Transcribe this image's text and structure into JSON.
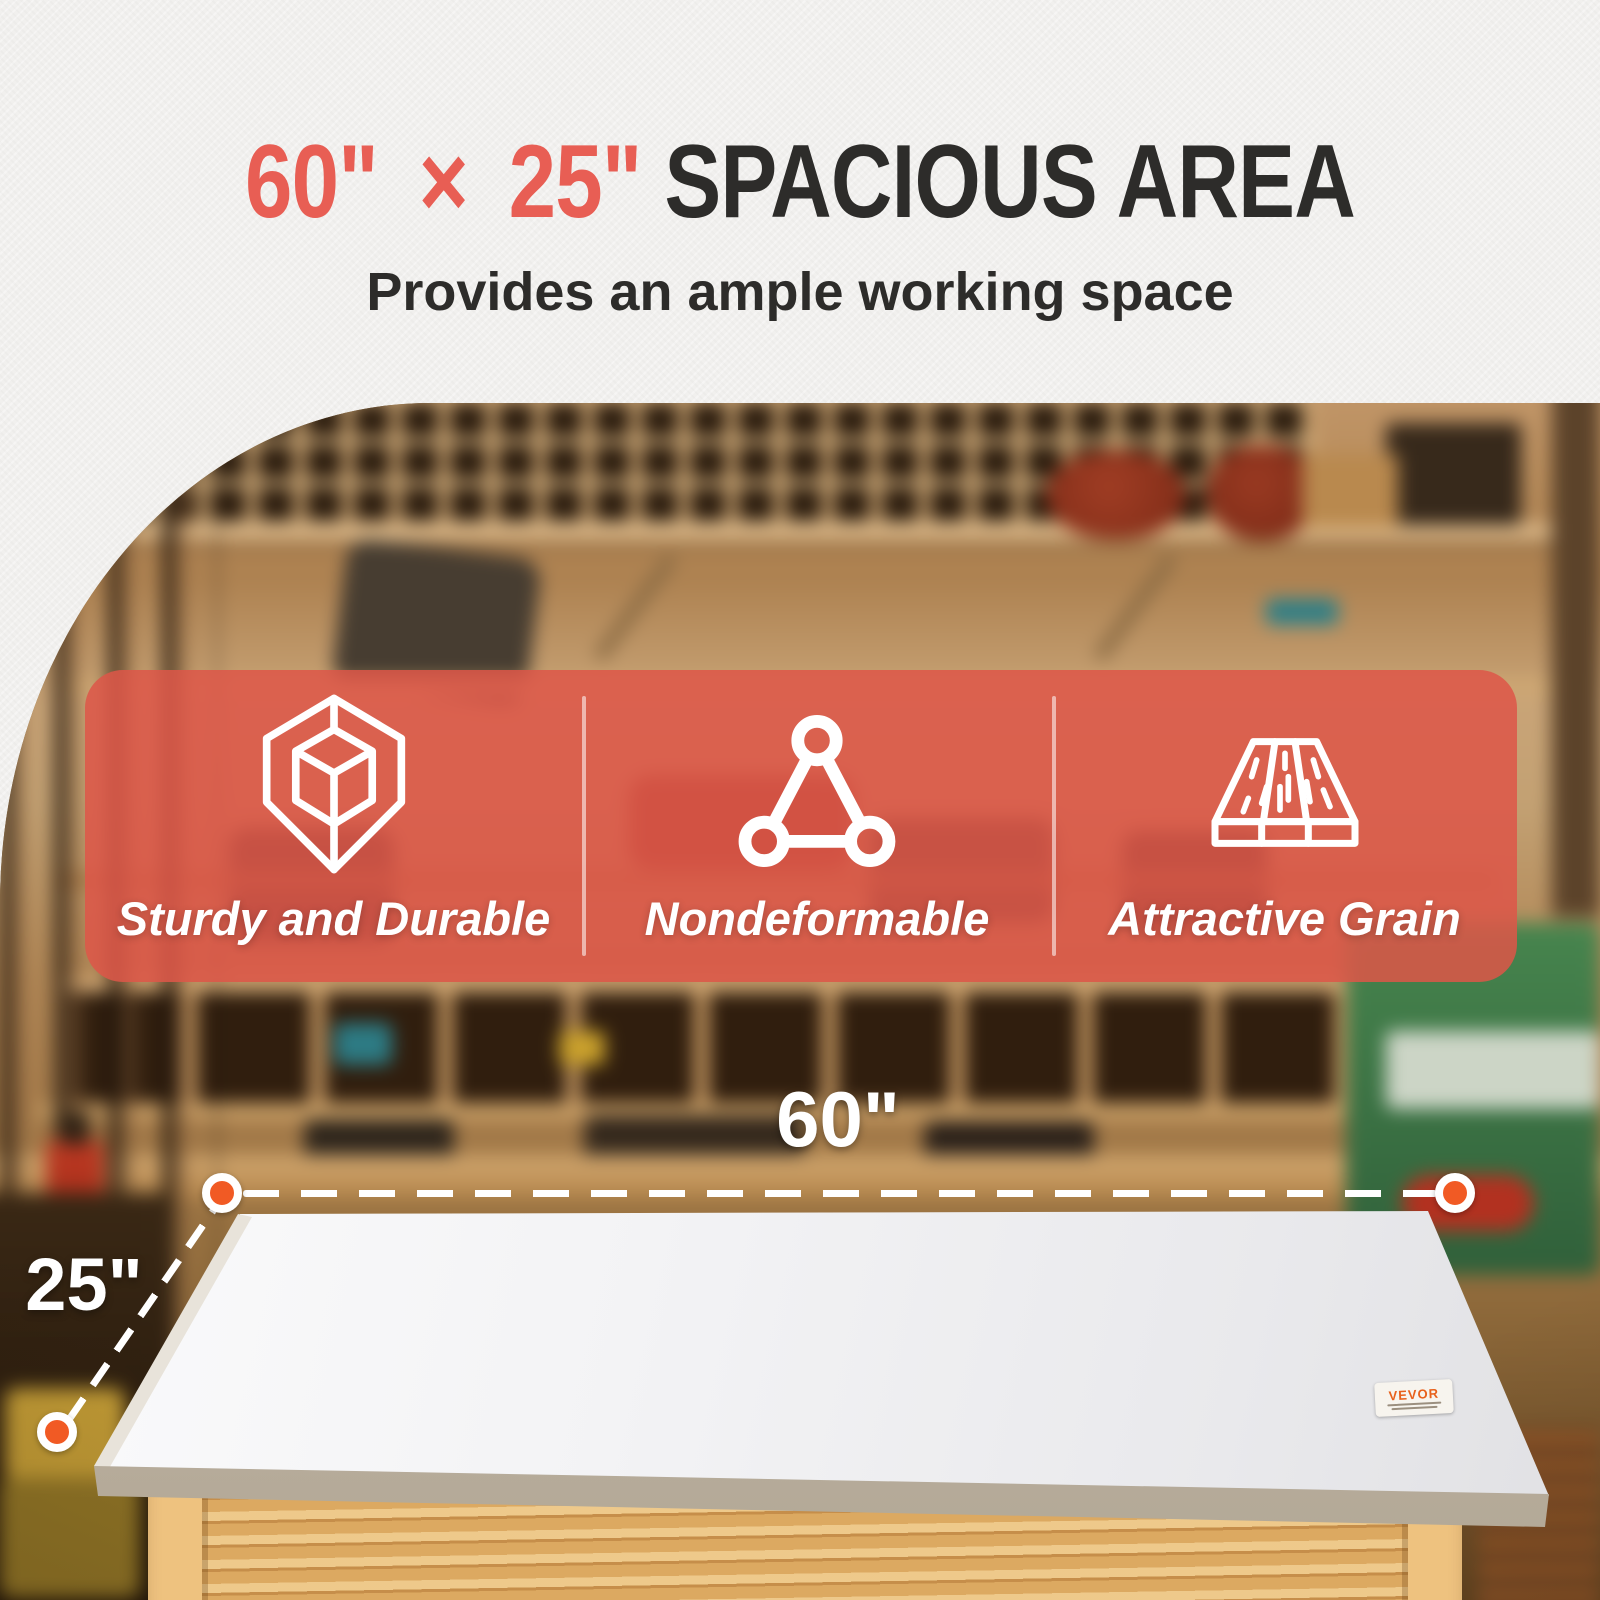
{
  "page": {
    "background": "#f1f0ee"
  },
  "header": {
    "title_accent": "60\" × 25\"",
    "title_rest": " SPACIOUS AREA",
    "subtitle": "Provides an ample working space",
    "accent_color": "#e85e54",
    "title_color": "#2d2c2a"
  },
  "features": {
    "panel_color": "#dd5648",
    "divider_color": "#ffffff",
    "items": [
      {
        "icon": "cube-wireframe-icon",
        "label": "Sturdy and Durable"
      },
      {
        "icon": "triangle-nodes-icon",
        "label": "Nondeformable"
      },
      {
        "icon": "wood-plank-icon",
        "label": "Attractive Grain"
      }
    ]
  },
  "dimensions": {
    "width_label": "60\"",
    "depth_label": "25\"",
    "marker_color": "#f15a24",
    "line_color": "#ffffff"
  },
  "product": {
    "brand_sticker": "VEVOR"
  }
}
